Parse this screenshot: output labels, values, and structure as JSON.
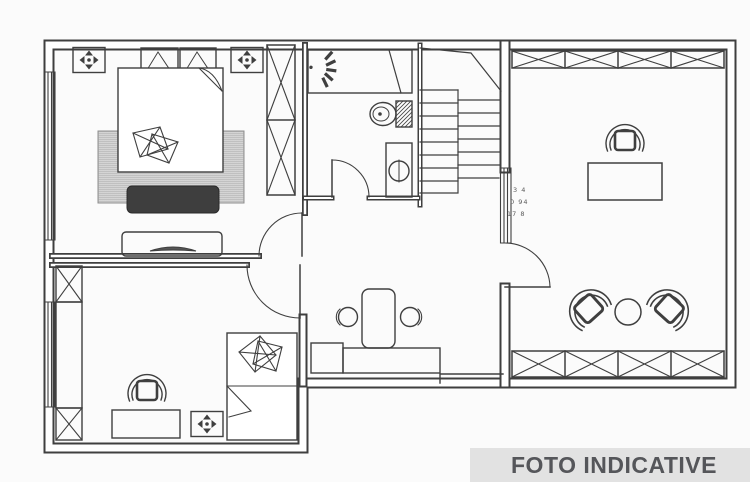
{
  "banner": {
    "label": "FOTO INDICATIVE"
  },
  "colors": {
    "page_bg": "#fbfbfb",
    "ink": "#3f3f3f",
    "paper": "#ffffff",
    "banner_bg": "#e2e2e2",
    "banner_fg": "#55565a",
    "dark_fill": "#3e3e3e",
    "rug_base": "#e4e4e4",
    "rug_dot": "#b9b9b9",
    "note": "#5a5a5a"
  },
  "annotations": {
    "stair_note": [
      "3 4",
      "0 94",
      "17 8"
    ]
  },
  "icons": {
    "vent-icon": "✥ four-arrow ceiling vent",
    "shower-head-icon": "fan spray",
    "toilet-icon": "bowl with hatched tank",
    "sink-icon": "circle basin in cabinet",
    "double-bed-icon": "rect with folded corner and pillows",
    "single-bed-icon": "rect with folded corner and pillows",
    "wardrobe-icon": "x-crossed box",
    "stairs-icon": "tread lines with break line",
    "office-chair-icon": "horseshoe chair",
    "lounge-chair-icon": "rotated horseshoe chair",
    "round-table-icon": "circle",
    "stool-icon": "small circle",
    "tv-icon": "lens on console",
    "door-icon": "leaf with quarter arc",
    "window-icon": "parallel hatch lines"
  }
}
